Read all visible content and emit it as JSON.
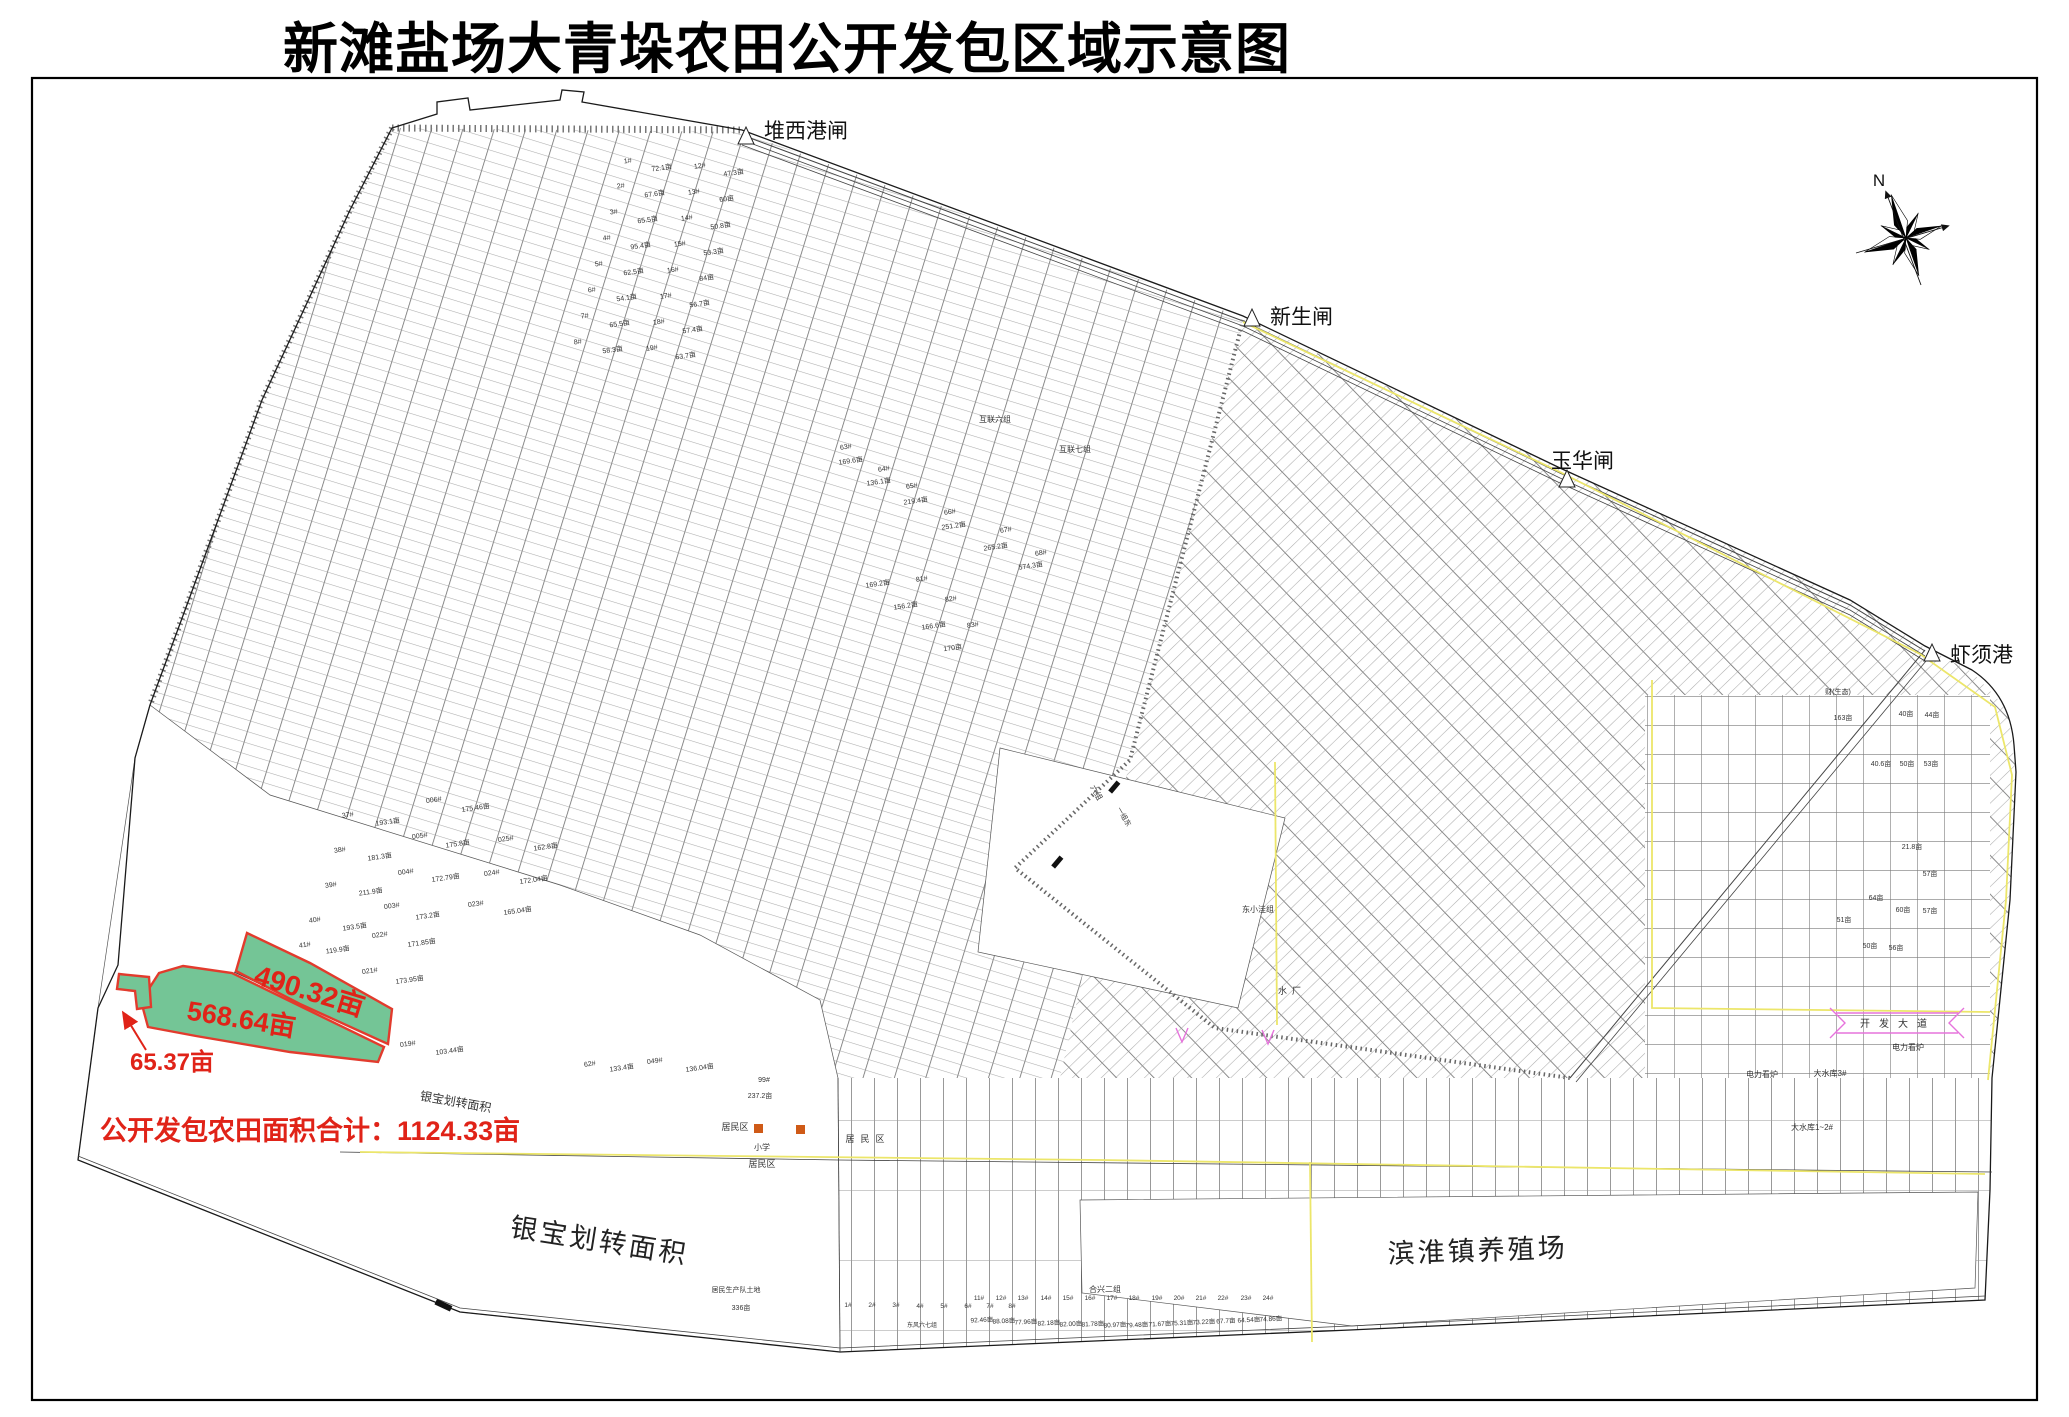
{
  "title": "新滩盐场大青垛农田公开发包区域示意图",
  "compass": {
    "label": "N",
    "cx": 1906,
    "cy": 238
  },
  "colors": {
    "red": "#e02318",
    "green": "#74c596",
    "green_edge": "#e23b2d",
    "yellow": "#ece66a",
    "pink": "#e673dc",
    "line": "#3a3a3a",
    "orange": "#cf5a17"
  },
  "gates": [
    {
      "label": "堆西港闸",
      "px": 746,
      "py": 144,
      "tx": 764,
      "ty": 138
    },
    {
      "label": "新生闸",
      "px": 1252,
      "py": 326,
      "tx": 1270,
      "ty": 324
    },
    {
      "label": "玉华闸",
      "px": 1567,
      "py": 487,
      "tx": 1551,
      "ty": 468
    },
    {
      "label": "虾须港",
      "px": 1932,
      "py": 661,
      "tx": 1950,
      "ty": 662
    }
  ],
  "highlight": {
    "areas": [
      {
        "label": "490.32亩",
        "points": "247,933 310,963 392,1009 388,1044 300,1004 236,971",
        "lx": 307,
        "ly": 1000,
        "lr": 17,
        "ls": 28
      },
      {
        "label": "568.64亩",
        "points": "183,966 232,973 384,1047 378,1062 290,1052 196,1036 148,1027 141,1001 159,973",
        "lx": 240,
        "ly": 1028,
        "lr": 9,
        "ls": 27
      },
      {
        "label": "65.37亩",
        "points": "119,974 149,977 151,1007 137,1009 135,991 117,989",
        "lx": 172,
        "ly": 1070,
        "lr": 0,
        "ls": 24
      }
    ],
    "arrow": {
      "x1": 146,
      "y1": 1050,
      "x2": 124,
      "y2": 1014
    },
    "total": {
      "text": "公开发包农田面积合计：1124.33亩",
      "x": 100,
      "y": 1140,
      "s": 27
    }
  },
  "region_labels": [
    {
      "t": "银宝划转面积",
      "x": 598,
      "y": 1250,
      "s": 27,
      "r": 9,
      "c": "#222",
      "ls2": 3
    },
    {
      "t": "滨淮镇养殖场",
      "x": 1478,
      "y": 1260,
      "s": 27,
      "r": -2,
      "c": "#222",
      "ls2": 3
    },
    {
      "t": "银宝划转面积",
      "x": 455,
      "y": 1106,
      "s": 12,
      "r": 10,
      "c": "#333"
    }
  ],
  "map_labels": [
    {
      "t": "居民区",
      "x": 735,
      "y": 1130,
      "s": 9
    },
    {
      "t": "居民区",
      "x": 868,
      "y": 1142,
      "s": 9,
      "ls2": 6
    },
    {
      "t": "居民区",
      "x": 762,
      "y": 1167,
      "s": 9
    },
    {
      "t": "小学",
      "x": 762,
      "y": 1150,
      "s": 8
    },
    {
      "t": "水厂",
      "x": 1292,
      "y": 994,
      "s": 9,
      "ls2": 5
    },
    {
      "t": "东小洼组",
      "x": 1258,
      "y": 912,
      "s": 8
    },
    {
      "t": "合兴二组",
      "x": 1105,
      "y": 1292,
      "s": 8
    },
    {
      "t": "大水库1~2#",
      "x": 1812,
      "y": 1130,
      "s": 8
    },
    {
      "t": "大水库3#",
      "x": 1830,
      "y": 1076,
      "s": 8
    },
    {
      "t": "电力看炉",
      "x": 1908,
      "y": 1050,
      "s": 8
    },
    {
      "t": "电力看炉",
      "x": 1762,
      "y": 1077,
      "s": 8
    },
    {
      "t": "开发大道",
      "x": 1898,
      "y": 1027,
      "s": 10,
      "ls2": 9
    },
    {
      "t": "互联六组",
      "x": 995,
      "y": 422,
      "s": 8
    },
    {
      "t": "互联七组",
      "x": 1075,
      "y": 452,
      "s": 8
    },
    {
      "t": "居民生产队土地",
      "x": 736,
      "y": 1292,
      "s": 7
    },
    {
      "t": "336亩",
      "x": 741,
      "y": 1310,
      "s": 7
    },
    {
      "t": "99#",
      "x": 764,
      "y": 1082,
      "s": 7
    },
    {
      "t": "237.2亩",
      "x": 760,
      "y": 1098,
      "s": 7
    },
    {
      "t": "六组",
      "x": 1094,
      "y": 794,
      "s": 8,
      "r": 60
    },
    {
      "t": "一组东",
      "x": 1122,
      "y": 818,
      "s": 7,
      "r": 60
    },
    {
      "t": "1#",
      "x": 628,
      "y": 163,
      "s": 7,
      "r": -8
    },
    {
      "t": "72.1亩",
      "x": 662,
      "y": 170,
      "s": 7,
      "r": -8
    },
    {
      "t": "2#",
      "x": 621,
      "y": 188,
      "s": 7,
      "r": -8
    },
    {
      "t": "67.6亩",
      "x": 655,
      "y": 196,
      "s": 7,
      "r": -8
    },
    {
      "t": "3#",
      "x": 614,
      "y": 214,
      "s": 7,
      "r": -8
    },
    {
      "t": "65.5亩",
      "x": 648,
      "y": 222,
      "s": 7,
      "r": -8
    },
    {
      "t": "4#",
      "x": 607,
      "y": 240,
      "s": 7,
      "r": -8
    },
    {
      "t": "95.4亩",
      "x": 641,
      "y": 248,
      "s": 7,
      "r": -8
    },
    {
      "t": "5#",
      "x": 599,
      "y": 266,
      "s": 7,
      "r": -8
    },
    {
      "t": "62.5亩",
      "x": 634,
      "y": 274,
      "s": 7,
      "r": -8
    },
    {
      "t": "6#",
      "x": 592,
      "y": 292,
      "s": 7,
      "r": -8
    },
    {
      "t": "54.1亩",
      "x": 627,
      "y": 300,
      "s": 7,
      "r": -8
    },
    {
      "t": "7#",
      "x": 585,
      "y": 318,
      "s": 7,
      "r": -8
    },
    {
      "t": "65.5亩",
      "x": 620,
      "y": 326,
      "s": 7,
      "r": -8
    },
    {
      "t": "8#",
      "x": 578,
      "y": 344,
      "s": 7,
      "r": -8
    },
    {
      "t": "58.3亩",
      "x": 613,
      "y": 352,
      "s": 7,
      "r": -8
    },
    {
      "t": "12#",
      "x": 700,
      "y": 168,
      "s": 7,
      "r": -8
    },
    {
      "t": "47.3亩",
      "x": 734,
      "y": 175,
      "s": 7,
      "r": -8
    },
    {
      "t": "13#",
      "x": 694,
      "y": 194,
      "s": 7,
      "r": -8
    },
    {
      "t": "60亩",
      "x": 727,
      "y": 201,
      "s": 7,
      "r": -8
    },
    {
      "t": "14#",
      "x": 687,
      "y": 220,
      "s": 7,
      "r": -8
    },
    {
      "t": "50.8亩",
      "x": 721,
      "y": 228,
      "s": 7,
      "r": -8
    },
    {
      "t": "15#",
      "x": 680,
      "y": 246,
      "s": 7,
      "r": -8
    },
    {
      "t": "53.3亩",
      "x": 714,
      "y": 254,
      "s": 7,
      "r": -8
    },
    {
      "t": "16#",
      "x": 673,
      "y": 272,
      "s": 7,
      "r": -8
    },
    {
      "t": "84亩",
      "x": 707,
      "y": 280,
      "s": 7,
      "r": -8
    },
    {
      "t": "17#",
      "x": 666,
      "y": 298,
      "s": 7,
      "r": -8
    },
    {
      "t": "56.7亩",
      "x": 700,
      "y": 306,
      "s": 7,
      "r": -8
    },
    {
      "t": "18#",
      "x": 659,
      "y": 324,
      "s": 7,
      "r": -8
    },
    {
      "t": "57.4亩",
      "x": 693,
      "y": 332,
      "s": 7,
      "r": -8
    },
    {
      "t": "19#",
      "x": 652,
      "y": 350,
      "s": 7,
      "r": -8
    },
    {
      "t": "63.7亩",
      "x": 686,
      "y": 358,
      "s": 7,
      "r": -8
    },
    {
      "t": "37#",
      "x": 348,
      "y": 817,
      "s": 7,
      "r": -8
    },
    {
      "t": "193.1亩",
      "x": 388,
      "y": 824,
      "s": 7,
      "r": -8
    },
    {
      "t": "38#",
      "x": 340,
      "y": 852,
      "s": 7,
      "r": -8
    },
    {
      "t": "181.3亩",
      "x": 380,
      "y": 859,
      "s": 7,
      "r": -8
    },
    {
      "t": "39#",
      "x": 331,
      "y": 887,
      "s": 7,
      "r": -8
    },
    {
      "t": "211.9亩",
      "x": 371,
      "y": 894,
      "s": 7,
      "r": -8
    },
    {
      "t": "40#",
      "x": 315,
      "y": 922,
      "s": 7,
      "r": -8
    },
    {
      "t": "193.5亩",
      "x": 355,
      "y": 929,
      "s": 7,
      "r": -8
    },
    {
      "t": "003#",
      "x": 392,
      "y": 908,
      "s": 7,
      "r": -8
    },
    {
      "t": "173.2亩",
      "x": 428,
      "y": 918,
      "s": 7,
      "r": -8
    },
    {
      "t": "004#",
      "x": 406,
      "y": 874,
      "s": 7,
      "r": -8
    },
    {
      "t": "172.79亩",
      "x": 446,
      "y": 880,
      "s": 7,
      "r": -8
    },
    {
      "t": "005#",
      "x": 420,
      "y": 838,
      "s": 7,
      "r": -8
    },
    {
      "t": "175.8亩",
      "x": 458,
      "y": 846,
      "s": 7,
      "r": -8
    },
    {
      "t": "006#",
      "x": 434,
      "y": 802,
      "s": 7,
      "r": -8
    },
    {
      "t": "175.46亩",
      "x": 476,
      "y": 810,
      "s": 7,
      "r": -8
    },
    {
      "t": "023#",
      "x": 476,
      "y": 906,
      "s": 7,
      "r": -8
    },
    {
      "t": "165.04亩",
      "x": 518,
      "y": 913,
      "s": 7,
      "r": -8
    },
    {
      "t": "024#",
      "x": 492,
      "y": 875,
      "s": 7,
      "r": -8
    },
    {
      "t": "172.04亩",
      "x": 534,
      "y": 882,
      "s": 7,
      "r": -8
    },
    {
      "t": "025#",
      "x": 506,
      "y": 841,
      "s": 7,
      "r": -8
    },
    {
      "t": "162.8亩",
      "x": 546,
      "y": 849,
      "s": 7,
      "r": -8
    },
    {
      "t": "019#",
      "x": 408,
      "y": 1046,
      "s": 7,
      "r": -8
    },
    {
      "t": "103.44亩",
      "x": 450,
      "y": 1053,
      "s": 7,
      "r": -8
    },
    {
      "t": "021#",
      "x": 370,
      "y": 973,
      "s": 7,
      "r": -8
    },
    {
      "t": "173.95亩",
      "x": 410,
      "y": 982,
      "s": 7,
      "r": -8
    },
    {
      "t": "022#",
      "x": 380,
      "y": 937,
      "s": 7,
      "r": -8
    },
    {
      "t": "171.85亩",
      "x": 422,
      "y": 945,
      "s": 7,
      "r": -8
    },
    {
      "t": "41#",
      "x": 305,
      "y": 947,
      "s": 7,
      "r": -8
    },
    {
      "t": "119.9亩",
      "x": 338,
      "y": 952,
      "s": 7,
      "r": -8
    },
    {
      "t": "62#",
      "x": 590,
      "y": 1066,
      "s": 7,
      "r": -8
    },
    {
      "t": "133.4亩",
      "x": 622,
      "y": 1070,
      "s": 7,
      "r": -8
    },
    {
      "t": "049#",
      "x": 655,
      "y": 1063,
      "s": 7,
      "r": -8
    },
    {
      "t": "136.04亩",
      "x": 700,
      "y": 1070,
      "s": 7,
      "r": -8
    },
    {
      "t": "63#",
      "x": 846,
      "y": 449,
      "s": 7,
      "r": -8
    },
    {
      "t": "169.6亩",
      "x": 851,
      "y": 463,
      "s": 7,
      "r": -8
    },
    {
      "t": "64#",
      "x": 884,
      "y": 471,
      "s": 7,
      "r": -8
    },
    {
      "t": "136.1亩",
      "x": 879,
      "y": 484,
      "s": 7,
      "r": -8
    },
    {
      "t": "65#",
      "x": 912,
      "y": 488,
      "s": 7,
      "r": -8
    },
    {
      "t": "219.4亩",
      "x": 916,
      "y": 503,
      "s": 7,
      "r": -8
    },
    {
      "t": "66#",
      "x": 950,
      "y": 514,
      "s": 7,
      "r": -8
    },
    {
      "t": "251.2亩",
      "x": 954,
      "y": 528,
      "s": 7,
      "r": -8
    },
    {
      "t": "67#",
      "x": 1006,
      "y": 532,
      "s": 7,
      "r": -8
    },
    {
      "t": "265.2亩",
      "x": 996,
      "y": 549,
      "s": 7,
      "r": -8
    },
    {
      "t": "68#",
      "x": 1041,
      "y": 555,
      "s": 7,
      "r": -8
    },
    {
      "t": "574.3亩",
      "x": 1031,
      "y": 568,
      "s": 7,
      "r": -8
    },
    {
      "t": "81#",
      "x": 922,
      "y": 581,
      "s": 7,
      "r": -8
    },
    {
      "t": "169.2亩",
      "x": 878,
      "y": 586,
      "s": 7,
      "r": -8
    },
    {
      "t": "82#",
      "x": 951,
      "y": 601,
      "s": 7,
      "r": -8
    },
    {
      "t": "156.2亩",
      "x": 906,
      "y": 608,
      "s": 7,
      "r": -8
    },
    {
      "t": "83#",
      "x": 973,
      "y": 627,
      "s": 7,
      "r": -8
    },
    {
      "t": "166.6亩",
      "x": 934,
      "y": 628,
      "s": 7,
      "r": -8
    },
    {
      "t": "170亩",
      "x": 953,
      "y": 650,
      "s": 7,
      "r": -8
    },
    {
      "t": "财(生态)",
      "x": 1838,
      "y": 694,
      "s": 7
    },
    {
      "t": "163亩",
      "x": 1843,
      "y": 720,
      "s": 7
    },
    {
      "t": "40亩",
      "x": 1906,
      "y": 716,
      "s": 7
    },
    {
      "t": "44亩",
      "x": 1932,
      "y": 717,
      "s": 7
    },
    {
      "t": "40.6亩",
      "x": 1881,
      "y": 766,
      "s": 7
    },
    {
      "t": "50亩",
      "x": 1907,
      "y": 766,
      "s": 7
    },
    {
      "t": "53亩",
      "x": 1931,
      "y": 766,
      "s": 7
    },
    {
      "t": "21.8亩",
      "x": 1912,
      "y": 849,
      "s": 7
    },
    {
      "t": "57亩",
      "x": 1930,
      "y": 876,
      "s": 7
    },
    {
      "t": "64亩",
      "x": 1876,
      "y": 900,
      "s": 7
    },
    {
      "t": "60亩",
      "x": 1903,
      "y": 912,
      "s": 7
    },
    {
      "t": "57亩",
      "x": 1930,
      "y": 913,
      "s": 7
    },
    {
      "t": "51亩",
      "x": 1844,
      "y": 922,
      "s": 7
    },
    {
      "t": "50亩",
      "x": 1870,
      "y": 948,
      "s": 7
    },
    {
      "t": "56亩",
      "x": 1896,
      "y": 950,
      "s": 7
    },
    {
      "t": "1#",
      "x": 848,
      "y": 1307,
      "s": 6.5
    },
    {
      "t": "2#",
      "x": 872,
      "y": 1307,
      "s": 6.5
    },
    {
      "t": "3#",
      "x": 896,
      "y": 1307,
      "s": 6.5
    },
    {
      "t": "4#",
      "x": 920,
      "y": 1308,
      "s": 6.5
    },
    {
      "t": "5#",
      "x": 944,
      "y": 1308,
      "s": 6.5
    },
    {
      "t": "6#",
      "x": 968,
      "y": 1308,
      "s": 6.5
    },
    {
      "t": "7#",
      "x": 990,
      "y": 1308,
      "s": 6.5
    },
    {
      "t": "8#",
      "x": 1012,
      "y": 1308,
      "s": 6.5
    },
    {
      "t": "东风六七组",
      "x": 922,
      "y": 1327,
      "s": 6
    },
    {
      "t": "11#",
      "x": 979,
      "y": 1300,
      "s": 6.5
    },
    {
      "t": "92.46亩",
      "x": 982,
      "y": 1322,
      "s": 6.5,
      "r": -3
    },
    {
      "t": "12#",
      "x": 1001,
      "y": 1300,
      "s": 6.5
    },
    {
      "t": "88.08亩",
      "x": 1004,
      "y": 1323,
      "s": 6.5,
      "r": -3
    },
    {
      "t": "13#",
      "x": 1023,
      "y": 1300,
      "s": 6.5
    },
    {
      "t": "77.96亩",
      "x": 1026,
      "y": 1324,
      "s": 6.5,
      "r": -3
    },
    {
      "t": "14#",
      "x": 1046,
      "y": 1300,
      "s": 6.5
    },
    {
      "t": "82.18亩",
      "x": 1049,
      "y": 1325,
      "s": 6.5,
      "r": -3
    },
    {
      "t": "15#",
      "x": 1068,
      "y": 1300,
      "s": 6.5
    },
    {
      "t": "82.00亩",
      "x": 1071,
      "y": 1326,
      "s": 6.5,
      "r": -3
    },
    {
      "t": "16#",
      "x": 1090,
      "y": 1300,
      "s": 6.5
    },
    {
      "t": "81.78亩",
      "x": 1093,
      "y": 1326,
      "s": 6.5,
      "r": -3
    },
    {
      "t": "17#",
      "x": 1112,
      "y": 1300,
      "s": 6.5
    },
    {
      "t": "80.97亩",
      "x": 1115,
      "y": 1327,
      "s": 6.5,
      "r": -3
    },
    {
      "t": "18#",
      "x": 1134,
      "y": 1300,
      "s": 6.5
    },
    {
      "t": "79.48亩",
      "x": 1137,
      "y": 1327,
      "s": 6.5,
      "r": -3
    },
    {
      "t": "19#",
      "x": 1157,
      "y": 1300,
      "s": 6.5
    },
    {
      "t": "71.67亩",
      "x": 1160,
      "y": 1326,
      "s": 6.5,
      "r": -3
    },
    {
      "t": "20#",
      "x": 1179,
      "y": 1300,
      "s": 6.5
    },
    {
      "t": "75.31亩",
      "x": 1182,
      "y": 1325,
      "s": 6.5,
      "r": -3
    },
    {
      "t": "21#",
      "x": 1201,
      "y": 1300,
      "s": 6.5
    },
    {
      "t": "73.22亩",
      "x": 1204,
      "y": 1324,
      "s": 6.5,
      "r": -3
    },
    {
      "t": "22#",
      "x": 1223,
      "y": 1300,
      "s": 6.5
    },
    {
      "t": "67.7亩",
      "x": 1226,
      "y": 1323,
      "s": 6.5,
      "r": -3
    },
    {
      "t": "23#",
      "x": 1246,
      "y": 1300,
      "s": 6.5
    },
    {
      "t": "64.54亩",
      "x": 1249,
      "y": 1322,
      "s": 6.5,
      "r": -3
    },
    {
      "t": "24#",
      "x": 1268,
      "y": 1300,
      "s": 6.5
    },
    {
      "t": "74.86亩",
      "x": 1271,
      "y": 1321,
      "s": 6.5,
      "r": -3
    }
  ]
}
